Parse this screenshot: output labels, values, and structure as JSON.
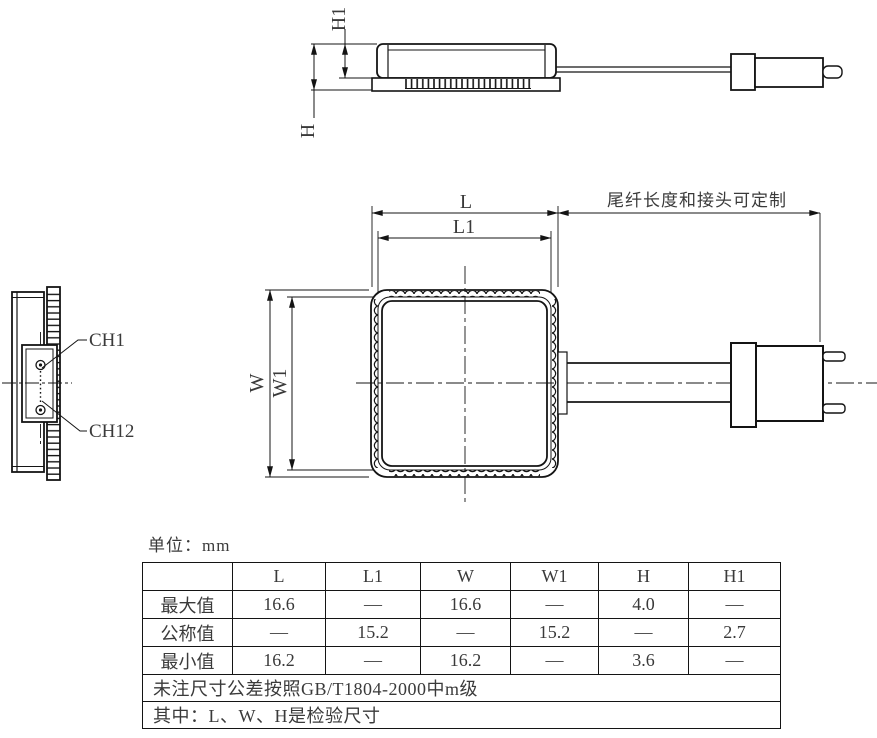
{
  "unit_label": "单位：mm",
  "side_view": {
    "dim_h": "H",
    "dim_h1": "H1"
  },
  "end_view": {
    "channel_top": "CH1",
    "channel_bottom": "CH12"
  },
  "top_view": {
    "dim_l": "L",
    "dim_l1": "L1",
    "dim_w": "W",
    "dim_w1": "W1",
    "pigtail_note": "尾纤长度和接头可定制"
  },
  "table": {
    "headers": [
      "",
      "L",
      "L1",
      "W",
      "W1",
      "H",
      "H1"
    ],
    "rows": [
      {
        "label": "最大值",
        "values": [
          "16.6",
          "—",
          "16.6",
          "—",
          "4.0",
          "—"
        ]
      },
      {
        "label": "公称值",
        "values": [
          "—",
          "15.2",
          "—",
          "15.2",
          "—",
          "2.7"
        ]
      },
      {
        "label": "最小值",
        "values": [
          "16.2",
          "—",
          "16.2",
          "—",
          "3.6",
          "—"
        ]
      }
    ],
    "notes": [
      "未注尺寸公差按照GB/T1804-2000中m级",
      "其中：L、W、H是检验尺寸"
    ]
  },
  "colors": {
    "line": "#141414",
    "background": "#ffffff"
  }
}
